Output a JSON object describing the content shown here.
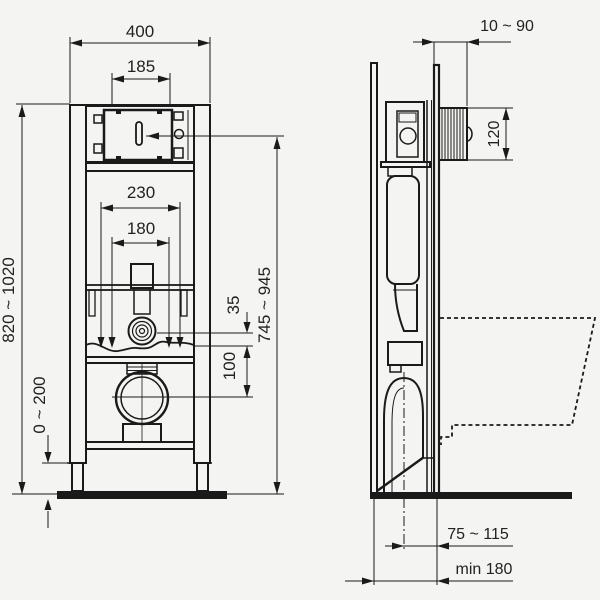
{
  "front_view": {
    "dims": {
      "frame_width": "400",
      "access_opening_width": "185",
      "upper_fixing_span": "230",
      "lower_fixing_span": "180",
      "frame_height": "820 ~ 1020",
      "foot_adjustment": "0 ~ 200",
      "flush_bend_offset": "35",
      "outlet_offset": "100",
      "actuator_height": "745 ~ 945"
    }
  },
  "side_view": {
    "dims": {
      "wall_finish_depth": "10 ~ 90",
      "access_shaft_height": "120",
      "outlet_to_wall": "75 ~ 115",
      "min_install_depth": "min 180"
    }
  }
}
